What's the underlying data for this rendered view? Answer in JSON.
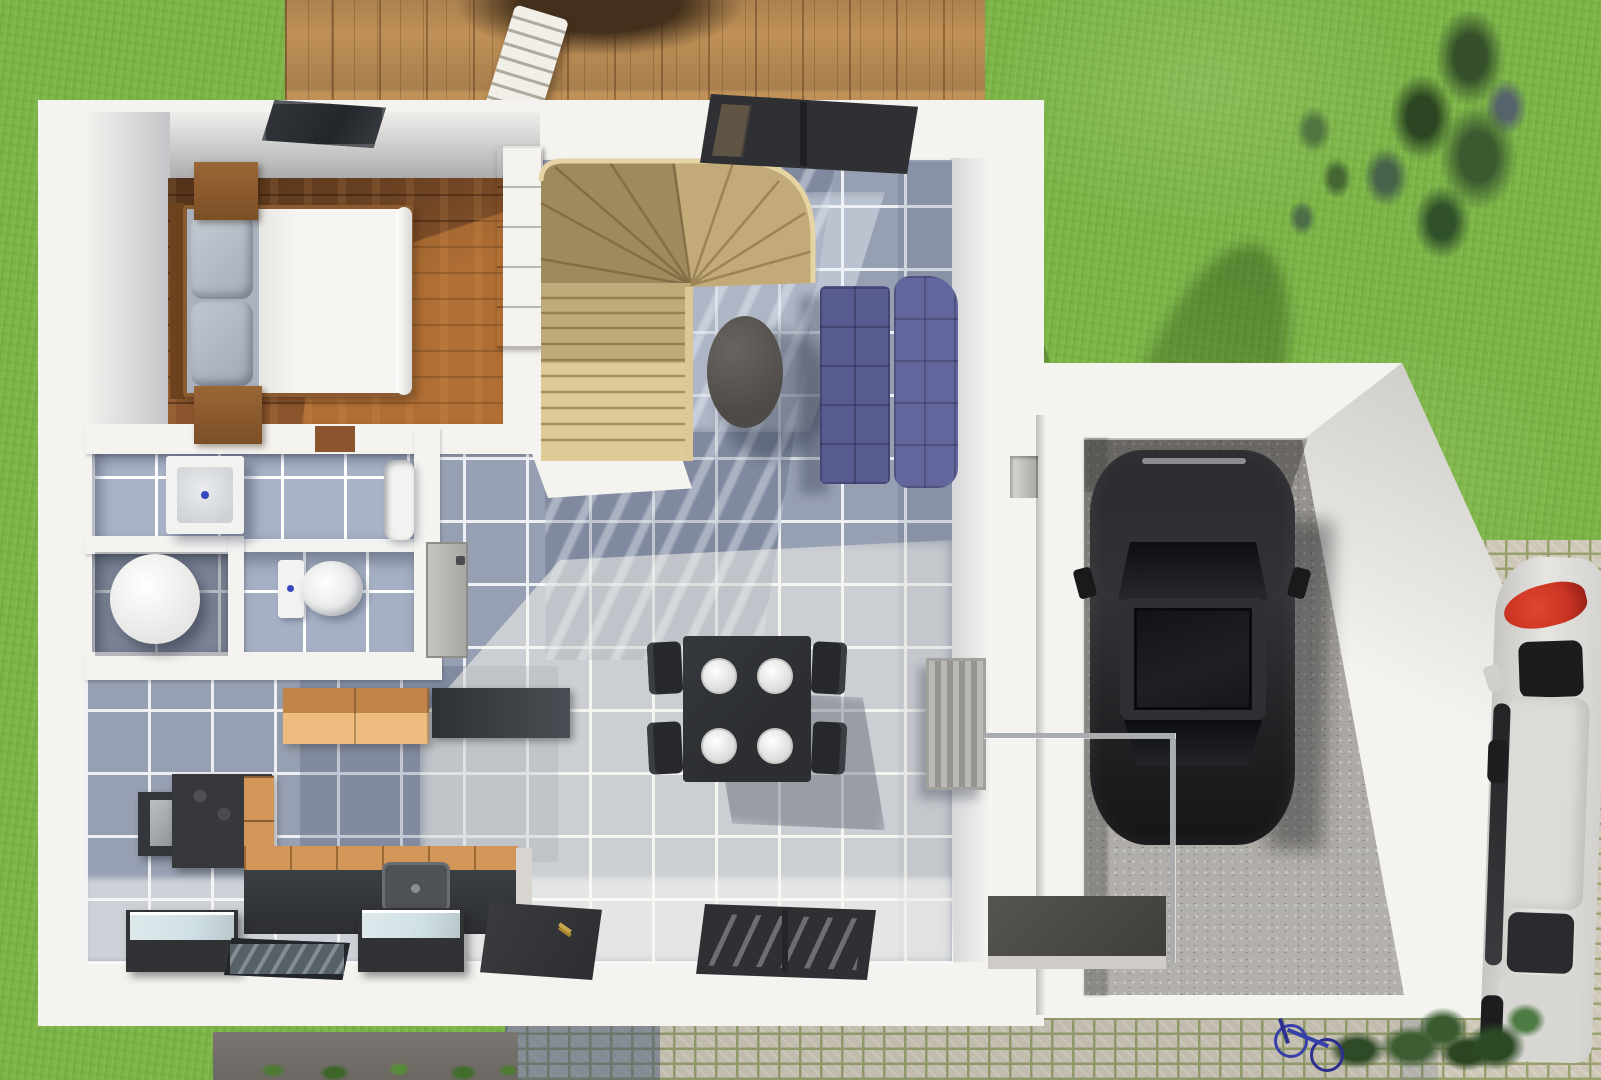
{
  "scene": {
    "type": "3d-floor-plan-render",
    "view": "top-down",
    "description": "Photoreal top-down 3D rendering of a single-storey house ground floor with furnished rooms, attached angled garage with black car, wooden deck, lawn, cobblestone driveway and a white car parked at the right edge",
    "rooms": [
      "bedroom",
      "stair-hall",
      "living-dining-room",
      "kitchen",
      "bathroom",
      "wc",
      "entry-hall",
      "garage"
    ],
    "objects": [
      "double-bed",
      "pillows",
      "duvet",
      "nightstand-top",
      "nightstand-bottom",
      "wardrobe",
      "skylight-window",
      "winder-staircase",
      "stair-handrail",
      "patio-window",
      "navy-sofa",
      "round-coffee-table",
      "dining-table",
      "four-plates",
      "four-chairs",
      "radiator",
      "wall-niche",
      "orange-wall-cabinet",
      "dark-wall-cabinet",
      "tall-kitchen-unit",
      "cooktop-counter",
      "kitchen-counter-sink",
      "glass-top-box-left",
      "glass-top-box-right",
      "floor-glass-panel",
      "front-door",
      "facade-window",
      "washbasin",
      "bathtub",
      "washing-machine",
      "toilet",
      "interior-door",
      "garage",
      "concrete-floor",
      "black-car",
      "glass-railing",
      "porch-platform",
      "deck",
      "deck-chair",
      "deck-table-shadow",
      "tree",
      "tree-shadow",
      "shrubs",
      "bicycle",
      "white-car",
      "cobblestone-driveway",
      "dark-walkway"
    ]
  },
  "palette": {
    "grass_base": "#7eb648",
    "deck_wood": "#bf9057",
    "house_white": "#f4f3f0",
    "wall_shade": "#d8d5d1",
    "wood_floor": "#8a552c",
    "wood_floor_sun": "#d08e4e",
    "tile_base": "#97a0b2",
    "tile_grout": "#eef0f3",
    "stair_wood": "#d9c493",
    "stair_shadow": "#b09a6e",
    "sofa_blue": "#585b90",
    "sofa_blue_light": "#63669c",
    "table_dark": "#2c2e32",
    "plate_white": "#f2f2f0",
    "radiator_gray": "#a8a6a1",
    "concrete": "#a8a5a0",
    "car_black": "#222225",
    "white_car": "#dcdbd7",
    "taillight_red": "#cc3524",
    "paver_light": "#c2bcae",
    "paver_moss": "#8f9868",
    "walkway_dark": "#6b6762",
    "cabinet_orange": "#d29758",
    "cabinet_orange_light": "#eebc7e",
    "counter_dark": "#36383c",
    "glass_top": "#cfe0e5",
    "door_dark": "#333538",
    "window_frame": "#2e3033",
    "window_glass": "#7a8187",
    "fixture_white": "#f2f2f0",
    "tree_dark": "#35502a",
    "shrub_green": "#3d5c31",
    "bike_blue": "#3640a8"
  }
}
